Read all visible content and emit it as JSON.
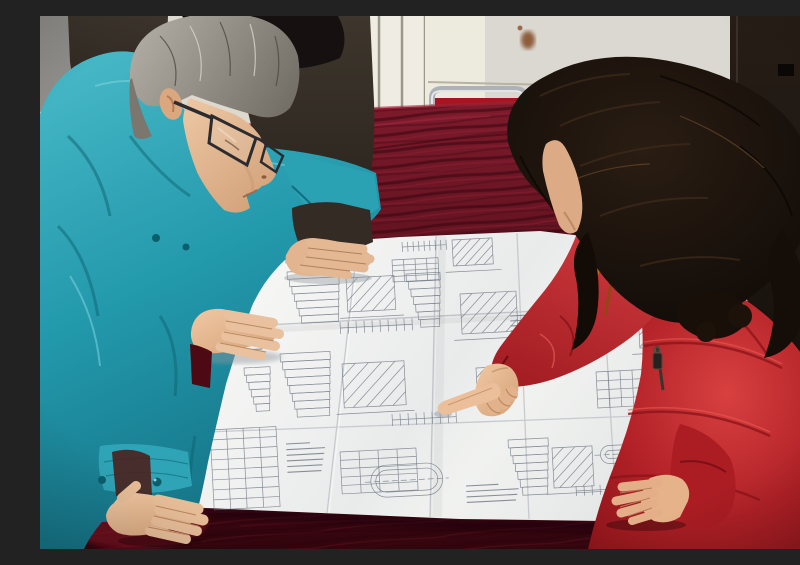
{
  "scene": {
    "type": "photograph",
    "description": "Three people lean over a large folded engineering blueprint spread on a dark red velvet-covered table. An older man with gray hair and glasses, wearing a teal work jacket, studies the drawings at left with both hands on the table. A woman with long dark wavy hair, wearing a red padded coat with an orange fur-trimmed hood, points at a detail on the drawing with her index finger while her other hand rests on the sheet. A third person in a dark jacket stands behind, one hand resting on the top edge of the paper.",
    "setting": "Indoor room with a cream radiator with vertical fins, pale wall panels, a dark brown door at right, and a red-cushioned metal-framed chair behind the table.",
    "people": [
      {
        "id": "man-left",
        "appearance": "gray hair, dark-rimmed glasses, teal work jacket with snap buttons",
        "pose": "bent over table, right hand on paper edge, left hand holding bottom corner"
      },
      {
        "id": "woman-right",
        "appearance": "long dark brown wavy hair, red down coat with orange fur hood trim and dark zipper pull",
        "pose": "leaning in, pointing at blueprint with right index finger, left hand flat on sheet"
      },
      {
        "id": "person-behind",
        "appearance": "black hair, dark gray-brown jacket, mostly hidden",
        "pose": "hand resting on top edge of blueprint"
      }
    ],
    "objects": [
      "engineering blueprint with fold creases",
      "dark red velvet table cover",
      "radiator",
      "metal chair with red cushion",
      "dark door",
      "rust stain on wall"
    ]
  },
  "palette": {
    "teal_jacket": "#2399ac",
    "red_coat": "#b82329",
    "velvet": "#5a0d1a",
    "velvet_bright": "#a01f2c",
    "paper": "#eef0ee",
    "wall": "#e9e5da",
    "panel": "#c9c7c1",
    "door": "#171110",
    "hair_gray": "#8b8781",
    "hair_dark": "#1c130d",
    "fur_trim": "#c97716",
    "skin": "#e5ba96",
    "chair_cushion": "#aa1420",
    "blueprint_line": "#6b7380"
  },
  "blueprint": {
    "content": "dense illegible technical detail drawings: section views, dimension chains, parts tables, hatched components, an obround vessel outline, and a tall title-block table",
    "clusters": [
      {
        "t": "dimrow",
        "x": 362,
        "y": 226,
        "w": 44,
        "h": 10,
        "n": 8
      },
      {
        "t": "part",
        "x": 412,
        "y": 224,
        "w": 40,
        "h": 26,
        "n": 6
      },
      {
        "t": "table",
        "x": 352,
        "y": 244,
        "w": 46,
        "h": 22,
        "n": 4
      },
      {
        "t": "dimrow",
        "x": 238,
        "y": 238,
        "w": 60,
        "h": 10,
        "n": 8
      },
      {
        "t": "stair",
        "x": 247,
        "y": 256,
        "w": 52,
        "h": 52,
        "n": 7
      },
      {
        "t": "part",
        "x": 306,
        "y": 262,
        "w": 48,
        "h": 34,
        "n": 6
      },
      {
        "t": "dimrow",
        "x": 300,
        "y": 306,
        "w": 72,
        "h": 12,
        "n": 9
      },
      {
        "t": "stair",
        "x": 366,
        "y": 258,
        "w": 34,
        "h": 54,
        "n": 7
      },
      {
        "t": "part",
        "x": 420,
        "y": 278,
        "w": 56,
        "h": 40,
        "n": 7
      },
      {
        "t": "table",
        "x": 548,
        "y": 240,
        "w": 58,
        "h": 24,
        "n": 3
      },
      {
        "t": "text",
        "x": 556,
        "y": 272,
        "w": 44,
        "h": 26,
        "n": 5
      },
      {
        "t": "part",
        "x": 598,
        "y": 296,
        "w": 46,
        "h": 36,
        "n": 6
      },
      {
        "t": "stair",
        "x": 240,
        "y": 338,
        "w": 50,
        "h": 64,
        "n": 8
      },
      {
        "t": "part",
        "x": 302,
        "y": 348,
        "w": 62,
        "h": 44,
        "n": 7
      },
      {
        "t": "dimrow",
        "x": 352,
        "y": 398,
        "w": 64,
        "h": 12,
        "n": 8
      },
      {
        "t": "part",
        "x": 436,
        "y": 352,
        "w": 20,
        "h": 28,
        "n": 4
      },
      {
        "t": "text",
        "x": 470,
        "y": 300,
        "w": 40,
        "h": 30,
        "n": 6
      },
      {
        "t": "table",
        "x": 556,
        "y": 356,
        "w": 48,
        "h": 36,
        "n": 4
      },
      {
        "t": "part",
        "x": 622,
        "y": 372,
        "w": 42,
        "h": 36,
        "n": 6
      },
      {
        "t": "table",
        "x": 170,
        "y": 414,
        "w": 66,
        "h": 80,
        "n": 8
      },
      {
        "t": "text",
        "x": 246,
        "y": 428,
        "w": 40,
        "h": 34,
        "n": 6
      },
      {
        "t": "table",
        "x": 300,
        "y": 436,
        "w": 76,
        "h": 42,
        "n": 5
      },
      {
        "t": "vessel",
        "x": 330,
        "y": 450,
        "w": 72,
        "h": 32,
        "n": 0
      },
      {
        "t": "stair",
        "x": 468,
        "y": 424,
        "w": 40,
        "h": 56,
        "n": 7
      },
      {
        "t": "part",
        "x": 512,
        "y": 432,
        "w": 40,
        "h": 40,
        "n": 6
      },
      {
        "t": "dimrow",
        "x": 536,
        "y": 470,
        "w": 56,
        "h": 10,
        "n": 7
      },
      {
        "t": "text",
        "x": 426,
        "y": 470,
        "w": 54,
        "h": 22,
        "n": 4
      },
      {
        "t": "vessel",
        "x": 560,
        "y": 430,
        "w": 40,
        "h": 18,
        "n": 0
      },
      {
        "t": "part",
        "x": 648,
        "y": 320,
        "w": 36,
        "h": 34,
        "n": 5
      },
      {
        "t": "text",
        "x": 652,
        "y": 396,
        "w": 34,
        "h": 24,
        "n": 4
      },
      {
        "t": "text",
        "x": 196,
        "y": 300,
        "w": 30,
        "h": 40,
        "n": 7
      },
      {
        "t": "stair",
        "x": 204,
        "y": 352,
        "w": 26,
        "h": 44,
        "n": 6
      }
    ]
  }
}
